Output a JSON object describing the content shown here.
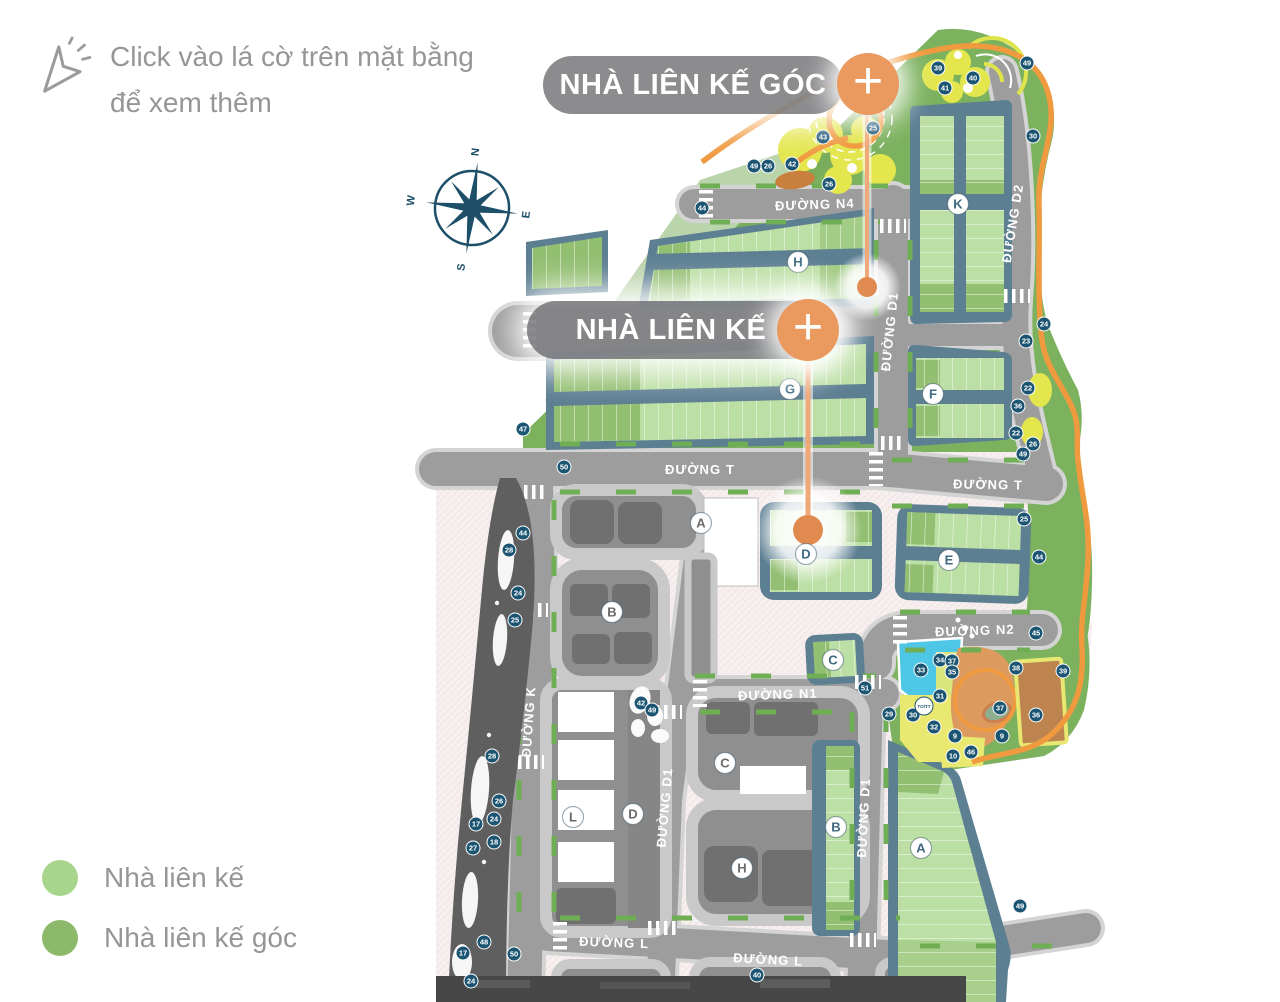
{
  "instruction": {
    "line1": "Click vào lá cờ trên mặt bằng",
    "line2": "để xem thêm"
  },
  "compass": {
    "n": "N",
    "e": "E",
    "s": "S",
    "w": "W"
  },
  "callouts": [
    {
      "label": "NHÀ LIÊN KẾ GÓC",
      "plus": "+"
    },
    {
      "label": "NHÀ LIÊN KẾ",
      "plus": "+"
    }
  ],
  "legend": [
    {
      "label": "Nhà liên kế",
      "color": "#a7d58c"
    },
    {
      "label": "Nhà liên kế góc",
      "color": "#8cba6a"
    }
  ],
  "map": {
    "colors": {
      "accent_orange": "#ea9a5f",
      "flag_orange": "#e08a4f",
      "marker_blue": "#1c5572",
      "slate": "#5d7f92",
      "lot_green": "#bcdfa5",
      "lot_green_dark": "#93bf72",
      "park_green": "#7cb15e",
      "road_gray": "#9d9d9d",
      "plaza_pink": "#f4e9e9",
      "pool_cyan": "#4ec7e7",
      "path_orange": "#f09a40",
      "playground_yellow": "#e3e64d"
    },
    "road_labels": [
      {
        "text": "ĐƯỜNG N4",
        "x": 815,
        "y": 209,
        "rot": -2
      },
      {
        "text": "ĐƯỜNG D1",
        "x": 894,
        "y": 332,
        "rot": -84
      },
      {
        "text": "ĐƯỜNG D2",
        "x": 1017,
        "y": 224,
        "rot": -81
      },
      {
        "text": "ĐƯỜNG T",
        "x": 700,
        "y": 474,
        "rot": 0
      },
      {
        "text": "ĐƯỜNG T",
        "x": 988,
        "y": 489,
        "rot": 1
      },
      {
        "text": "ĐƯỜNG N2",
        "x": 975,
        "y": 635,
        "rot": -2
      },
      {
        "text": "ĐƯỜNG N1",
        "x": 778,
        "y": 699,
        "rot": -2
      },
      {
        "text": "ĐƯỜNG K",
        "x": 533,
        "y": 722,
        "rot": -86
      },
      {
        "text": "ĐƯỜNG D1",
        "x": 669,
        "y": 808,
        "rot": -85
      },
      {
        "text": "ĐƯỜNG D1",
        "x": 868,
        "y": 818,
        "rot": -87
      },
      {
        "text": "ĐƯỜNG L",
        "x": 614,
        "y": 947,
        "rot": 2
      },
      {
        "text": "ĐƯỜNG L",
        "x": 768,
        "y": 964,
        "rot": 3
      }
    ],
    "block_labels": [
      {
        "t": "K",
        "x": 958,
        "y": 204,
        "k": "green"
      },
      {
        "t": "H",
        "x": 798,
        "y": 262,
        "k": "green"
      },
      {
        "t": "G",
        "x": 790,
        "y": 389,
        "k": "green"
      },
      {
        "t": "F",
        "x": 933,
        "y": 394,
        "k": "green"
      },
      {
        "t": "E",
        "x": 949,
        "y": 560,
        "k": "green"
      },
      {
        "t": "D",
        "x": 806,
        "y": 554,
        "k": "green"
      },
      {
        "t": "C",
        "x": 833,
        "y": 660,
        "k": "green"
      },
      {
        "t": "B",
        "x": 836,
        "y": 827,
        "k": "green"
      },
      {
        "t": "A",
        "x": 921,
        "y": 848,
        "k": "green"
      },
      {
        "t": "A",
        "x": 701,
        "y": 523,
        "k": "gray"
      },
      {
        "t": "B",
        "x": 612,
        "y": 612,
        "k": "gray"
      },
      {
        "t": "C",
        "x": 725,
        "y": 763,
        "k": "gray"
      },
      {
        "t": "D",
        "x": 633,
        "y": 814,
        "k": "gray"
      },
      {
        "t": "H",
        "x": 742,
        "y": 868,
        "k": "gray"
      },
      {
        "t": "L",
        "x": 573,
        "y": 817,
        "k": "gray"
      }
    ],
    "special_marker": {
      "text": "TO/TT",
      "x": 924,
      "y": 706
    },
    "markers": [
      {
        "n": "39",
        "x": 938,
        "y": 68
      },
      {
        "n": "40",
        "x": 973,
        "y": 78
      },
      {
        "n": "41",
        "x": 945,
        "y": 88
      },
      {
        "n": "49",
        "x": 1027,
        "y": 63
      },
      {
        "n": "30",
        "x": 1033,
        "y": 136
      },
      {
        "n": "25",
        "x": 873,
        "y": 128
      },
      {
        "n": "43",
        "x": 823,
        "y": 137
      },
      {
        "n": "42",
        "x": 792,
        "y": 164
      },
      {
        "n": "26",
        "x": 768,
        "y": 166
      },
      {
        "n": "49",
        "x": 754,
        "y": 166
      },
      {
        "n": "26",
        "x": 829,
        "y": 184
      },
      {
        "n": "44",
        "x": 702,
        "y": 208
      },
      {
        "n": "24",
        "x": 1044,
        "y": 324
      },
      {
        "n": "23",
        "x": 1026,
        "y": 341
      },
      {
        "n": "22",
        "x": 1028,
        "y": 388
      },
      {
        "n": "36",
        "x": 1018,
        "y": 406
      },
      {
        "n": "22",
        "x": 1016,
        "y": 433
      },
      {
        "n": "26",
        "x": 1033,
        "y": 444
      },
      {
        "n": "49",
        "x": 1023,
        "y": 454
      },
      {
        "n": "25",
        "x": 1024,
        "y": 519
      },
      {
        "n": "44",
        "x": 1039,
        "y": 557
      },
      {
        "n": "45",
        "x": 1036,
        "y": 633
      },
      {
        "n": "38",
        "x": 1016,
        "y": 668
      },
      {
        "n": "39",
        "x": 1063,
        "y": 671
      },
      {
        "n": "34",
        "x": 940,
        "y": 660
      },
      {
        "n": "37",
        "x": 952,
        "y": 661
      },
      {
        "n": "33",
        "x": 921,
        "y": 670
      },
      {
        "n": "35",
        "x": 952,
        "y": 672
      },
      {
        "n": "31",
        "x": 940,
        "y": 696
      },
      {
        "n": "29",
        "x": 889,
        "y": 714
      },
      {
        "n": "30",
        "x": 913,
        "y": 715
      },
      {
        "n": "32",
        "x": 934,
        "y": 727
      },
      {
        "n": "37",
        "x": 1000,
        "y": 708
      },
      {
        "n": "36",
        "x": 1036,
        "y": 715
      },
      {
        "n": "9",
        "x": 955,
        "y": 736
      },
      {
        "n": "9",
        "x": 1002,
        "y": 736
      },
      {
        "n": "46",
        "x": 971,
        "y": 752
      },
      {
        "n": "10",
        "x": 953,
        "y": 756
      },
      {
        "n": "47",
        "x": 523,
        "y": 429
      },
      {
        "n": "50",
        "x": 564,
        "y": 467
      },
      {
        "n": "44",
        "x": 523,
        "y": 533
      },
      {
        "n": "28",
        "x": 509,
        "y": 550
      },
      {
        "n": "24",
        "x": 518,
        "y": 593
      },
      {
        "n": "25",
        "x": 515,
        "y": 620
      },
      {
        "n": "42",
        "x": 641,
        "y": 703
      },
      {
        "n": "49",
        "x": 652,
        "y": 710
      },
      {
        "n": "51",
        "x": 865,
        "y": 688
      },
      {
        "n": "28",
        "x": 492,
        "y": 756
      },
      {
        "n": "26",
        "x": 499,
        "y": 801
      },
      {
        "n": "24",
        "x": 494,
        "y": 819
      },
      {
        "n": "17",
        "x": 476,
        "y": 824
      },
      {
        "n": "18",
        "x": 494,
        "y": 842
      },
      {
        "n": "27",
        "x": 473,
        "y": 848
      },
      {
        "n": "48",
        "x": 484,
        "y": 942
      },
      {
        "n": "17",
        "x": 463,
        "y": 953
      },
      {
        "n": "50",
        "x": 514,
        "y": 954
      },
      {
        "n": "24",
        "x": 471,
        "y": 981
      },
      {
        "n": "40",
        "x": 757,
        "y": 975
      },
      {
        "n": "49",
        "x": 1020,
        "y": 906
      }
    ]
  }
}
